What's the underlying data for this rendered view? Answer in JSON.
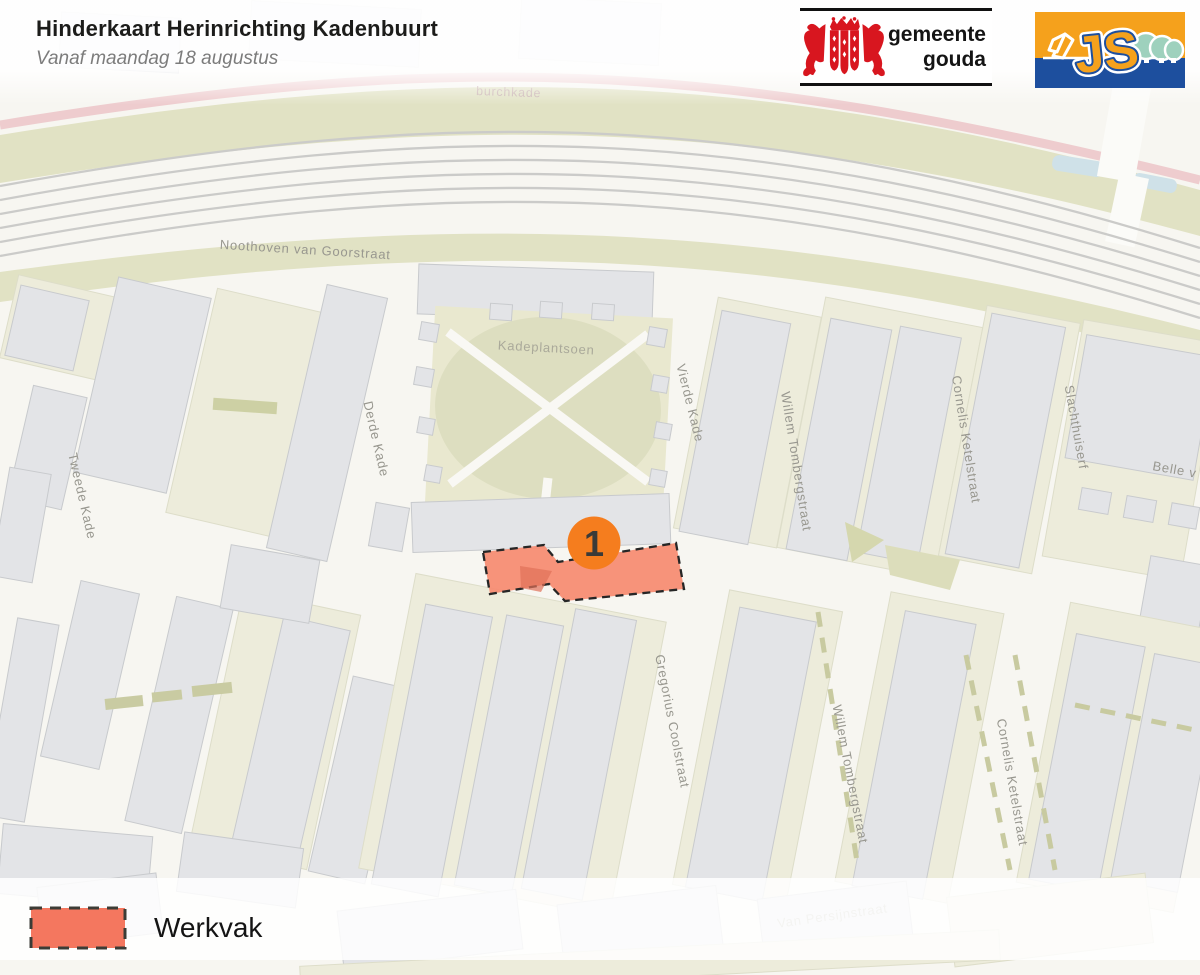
{
  "header": {
    "title": "Hinderkaart Herinrichting Kadenbuurt",
    "subtitle": "Vanaf maandag 18 augustus"
  },
  "logos": {
    "gemeente_gouda": {
      "line1": "gemeente",
      "line2": "gouda"
    },
    "contractor": {
      "monogram": "JS"
    }
  },
  "map": {
    "labels": [
      {
        "id": "burchkade",
        "text": "burchkade"
      },
      {
        "id": "noothoven-van-goorstraat",
        "text": "Noothoven van Goorstraat"
      },
      {
        "id": "kadeplantsoen",
        "text": "Kadeplantsoen"
      },
      {
        "id": "tweede-kade",
        "text": "Tweede Kade"
      },
      {
        "id": "derde-kade",
        "text": "Derde Kade"
      },
      {
        "id": "vierde-kade",
        "text": "Vierde Kade"
      },
      {
        "id": "willem-tombergstraat-north",
        "text": "Willem Tombergstraat"
      },
      {
        "id": "willem-tombergstraat-south",
        "text": "Willem Tombergstraat"
      },
      {
        "id": "cornelis-ketelstraat-north",
        "text": "Cornelis Ketelstraat"
      },
      {
        "id": "cornelis-ketelstraat-south",
        "text": "Cornelis Ketelstraat"
      },
      {
        "id": "slachthuiserf",
        "text": "Slachthuiserf"
      },
      {
        "id": "belle-v",
        "text": "Belle v"
      },
      {
        "id": "gregorius-coolstraat",
        "text": "Gregorius Coolstraat"
      },
      {
        "id": "van-persijnstraat",
        "text": "Van Persijnstraat"
      }
    ],
    "marker": {
      "number": "1"
    },
    "colors": {
      "werkvak_fill": "#F68B71",
      "marker_orange": "#F57D1E",
      "park_green": "#DDDEC0",
      "rail_olive": "#E1E2C4"
    }
  },
  "legend": {
    "items": [
      {
        "label": "Werkvak"
      }
    ]
  }
}
